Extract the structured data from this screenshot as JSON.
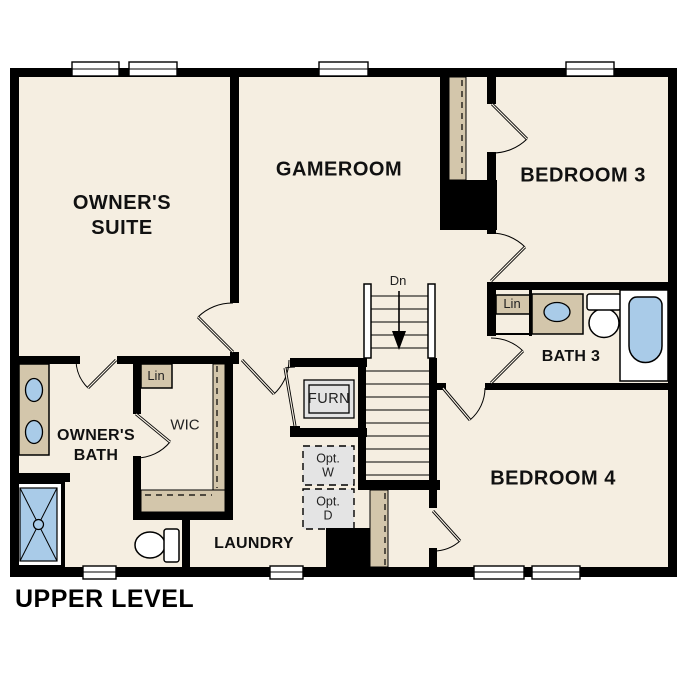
{
  "title": "UPPER LEVEL",
  "rooms": {
    "owners_suite": {
      "line1": "OWNER'S",
      "line2": "SUITE"
    },
    "gameroom": {
      "label": "GAMEROOM"
    },
    "bedroom_3": {
      "label": "BEDROOM 3"
    },
    "bedroom_4": {
      "label": "BEDROOM 4"
    },
    "bath_3": {
      "label": "BATH 3"
    },
    "owners_bath": {
      "line1": "OWNER'S",
      "line2": "BATH"
    },
    "laundry": {
      "label": "LAUNDRY"
    },
    "wic": {
      "label": "WIC"
    }
  },
  "closets": {
    "linen_wic": "Lin",
    "linen_bath3": "Lin"
  },
  "equipment": {
    "furnace": "FURN",
    "washer_line1": "Opt.",
    "washer_line2": "W",
    "dryer_line1": "Opt.",
    "dryer_line2": "D"
  },
  "stairs": {
    "direction": "Dn"
  },
  "colors": {
    "wall": "#000000",
    "floor": "#f5eee1",
    "closet_tan": "#d3c6ab",
    "fixture_blue": "#a9cbe8",
    "appliance_gray": "#e4e4e4",
    "background": "#ffffff"
  }
}
